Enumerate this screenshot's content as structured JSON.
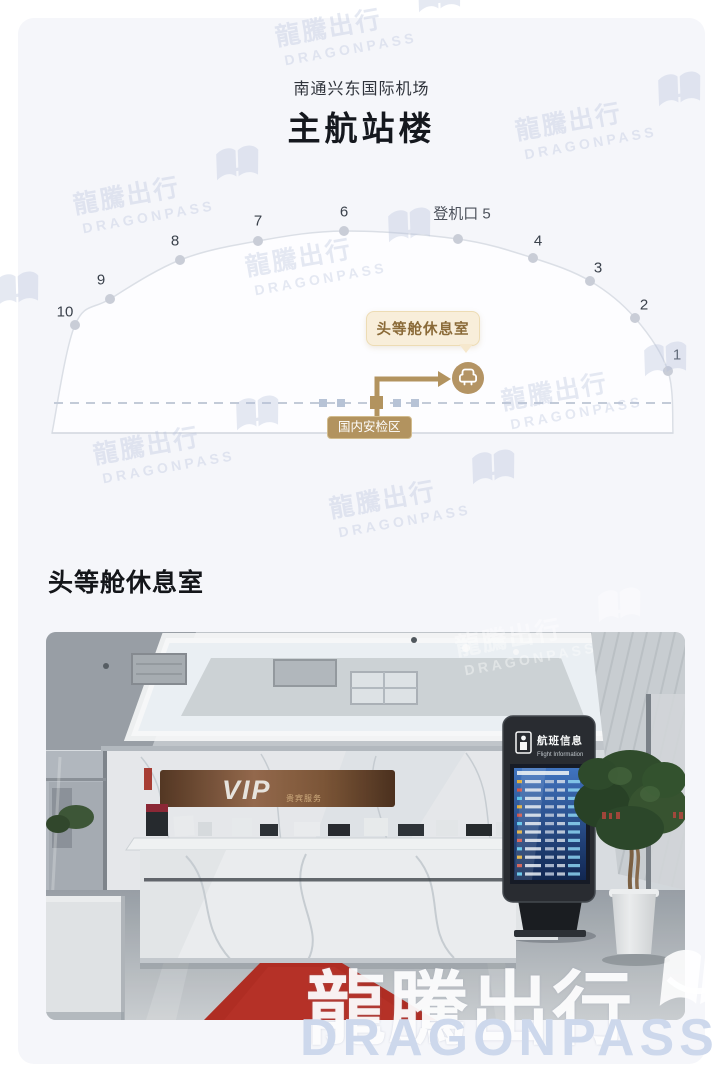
{
  "header": {
    "airport": "南通兴东国际机场",
    "terminal": "主航站楼"
  },
  "map": {
    "gate5_label": "登机口 5",
    "gates": [
      "1",
      "2",
      "3",
      "4",
      "6",
      "7",
      "8",
      "9",
      "10"
    ],
    "lounge_tooltip": "头等舱休息室",
    "security_label": "国内安检区",
    "lounge_icon": "armchair-icon"
  },
  "section": {
    "title": "头等舱休息室"
  },
  "photo": {
    "vip_sign": "VIP",
    "vip_sign_sub": "贵宾服务",
    "kiosk_title_cn": "航班信息",
    "kiosk_title_en": "Flight Information"
  },
  "watermark": {
    "cn": "龍騰出行",
    "en": "DRAGONPASS"
  },
  "colors": {
    "accent_gold": "#b2935f",
    "tooltip_bg": "#f8eeda",
    "tooltip_text": "#8a6a38",
    "card_bg": "#f5f6fa",
    "watermark_blue": "#b6c1dc",
    "carpet_red": "#b42a1f",
    "kiosk_screen_blue": "#2a5aa8"
  }
}
